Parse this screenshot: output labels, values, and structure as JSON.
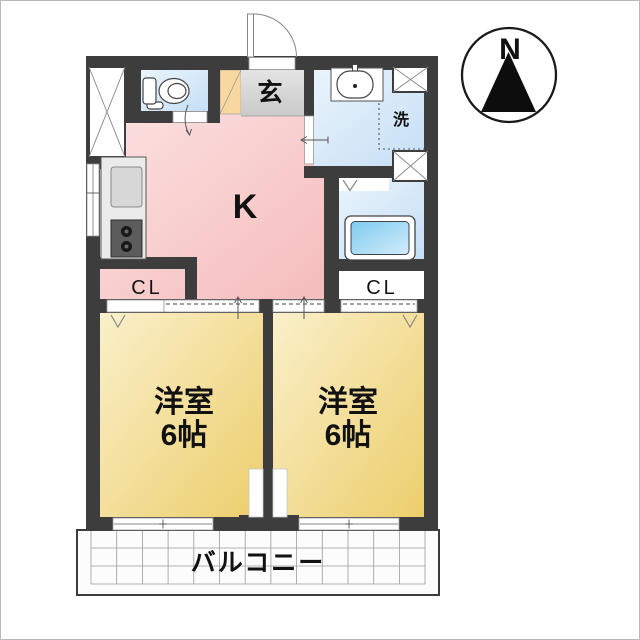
{
  "compass": {
    "label": "N"
  },
  "labels": {
    "kitchen": "K",
    "entrance": "玄",
    "laundry": "洗",
    "closet_left": "CL",
    "closet_right": "CL",
    "balcony": "バルコニー"
  },
  "bedroom_left": {
    "name": "洋室",
    "size": "6帖"
  },
  "bedroom_right": {
    "name": "洋室",
    "size": "6帖"
  },
  "colors": {
    "wall": "#3d3d3d",
    "kitchen_floor": "#f6c2c2",
    "bedroom_floor": "#efd277",
    "wet_area_floor": "#cde3f6",
    "bathtub": "#7ecbf0",
    "entrance_floor": "#d6d6d6",
    "shoe_cabinet": "#f8d7a0"
  }
}
